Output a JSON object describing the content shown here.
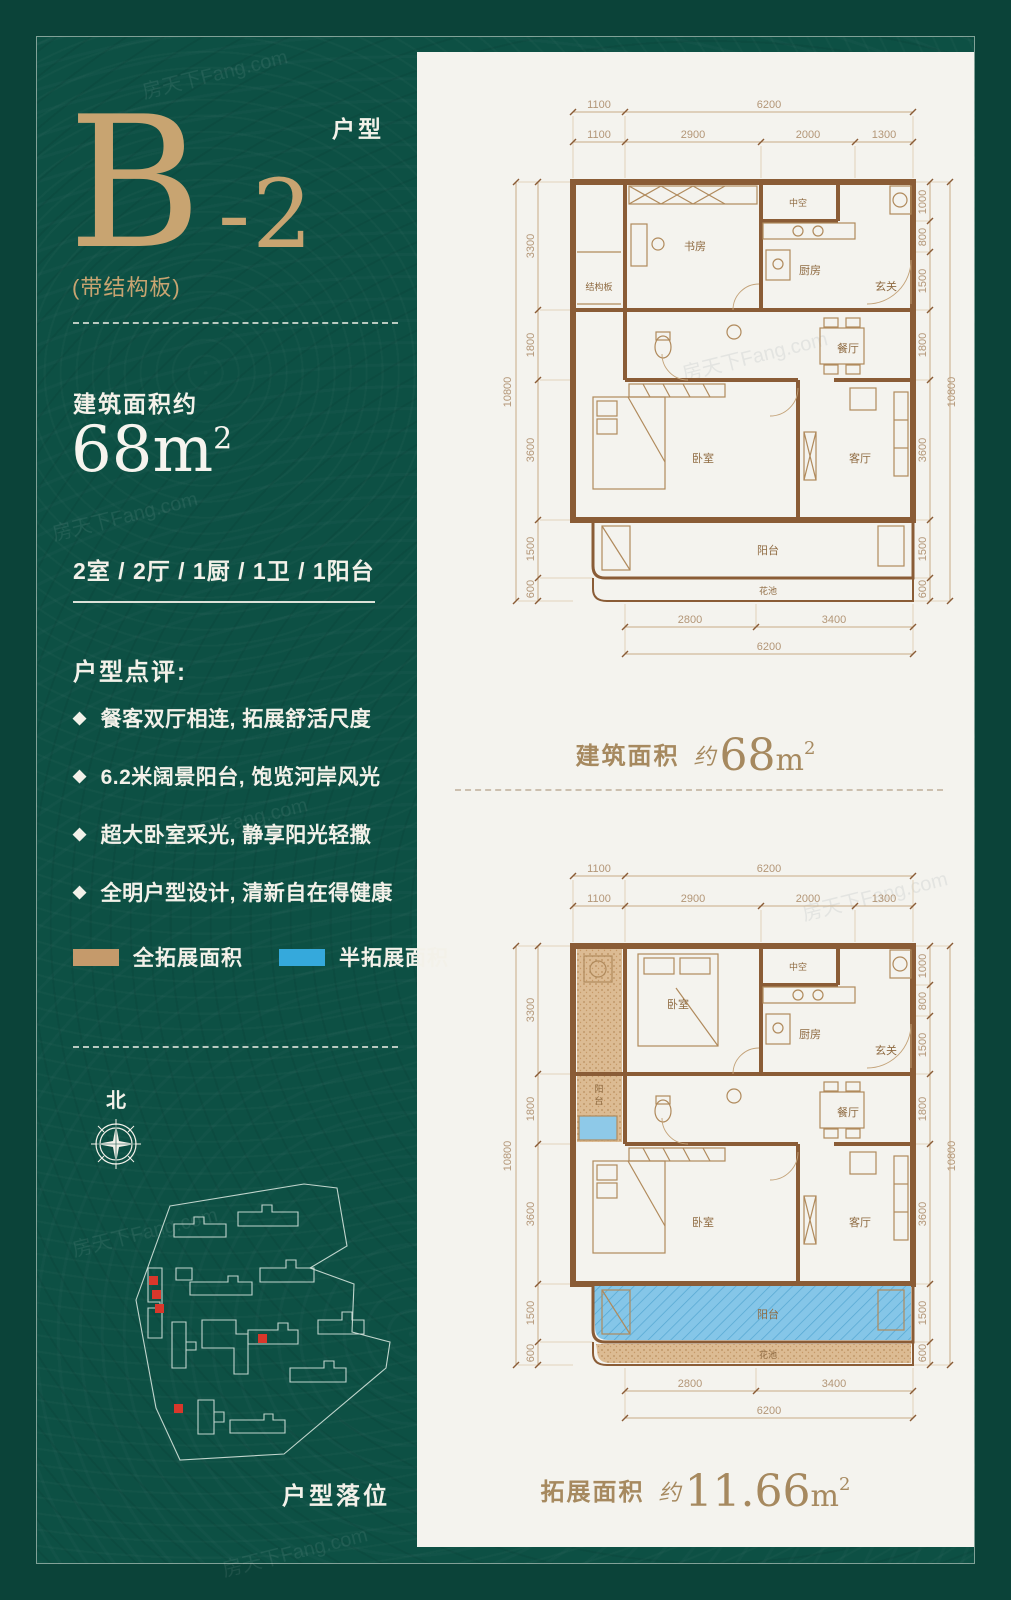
{
  "watermark": "房天下Fang.com",
  "colors": {
    "background_green": "#0d5044",
    "frame_green": "#0b4339",
    "gold": "#c8a471",
    "panel_cream": "#f4f3ee",
    "plan_wall_brown": "#8a5c36",
    "legend_full_color": "#c59a6b",
    "legend_half_color": "#35a9dc",
    "site_red": "#d9372b"
  },
  "left_panel": {
    "unit_type_label": "户型",
    "unit_name": "B",
    "unit_suffix": "-2",
    "structure_note": "(带结构板)",
    "area_caption": "建筑面积约",
    "area_value": "68",
    "area_unit": "m",
    "area_sup": "2",
    "layout_summary": "2室 / 2厅 / 1厨 / 1卫 / 1阳台",
    "review_title": "户型点评:",
    "bullet_glyph": "◆",
    "review_items": [
      "餐客双厅相连, 拓展舒活尺度",
      "6.2米阔景阳台, 饱览河岸风光",
      "超大卧室采光, 静享阳光轻撒",
      "全明户型设计, 清新自在得健康"
    ],
    "legend_full": "全拓展面积",
    "legend_half": "半拓展面积",
    "compass_north": "北",
    "site_caption": "户型落位"
  },
  "plans": {
    "dims": {
      "top_row1": [
        "1100",
        "6200"
      ],
      "top_row2": [
        "1100",
        "2900",
        "2000",
        "1300"
      ],
      "left": [
        "3300",
        "1800",
        "3600",
        "1500",
        "600"
      ],
      "left_total": "10800",
      "right": [
        "1000",
        "800",
        "1500",
        "1800",
        "3600",
        "1500",
        "600"
      ],
      "right_total": "10800",
      "bottom": [
        "2800",
        "3400"
      ],
      "bottom_total": "6200"
    },
    "rooms": {
      "void": "中空",
      "study": "书房",
      "kitchen": "厨房",
      "entry": "玄关",
      "slab": "结构板",
      "dining": "餐厅",
      "bedroom": "卧室",
      "living": "客厅",
      "balcony": "阳台",
      "planter": "花池"
    },
    "rooms2": {
      "bedroom_top": "卧室",
      "balcony_char1": "阳",
      "balcony_char2": "台"
    },
    "caption_top": {
      "label": "建筑面积",
      "approx": "约",
      "value": "68",
      "unit": "m",
      "sup": "2"
    },
    "caption_bottom": {
      "label": "拓展面积",
      "approx": "约",
      "value": "11.66",
      "unit": "m",
      "sup": "2"
    }
  }
}
